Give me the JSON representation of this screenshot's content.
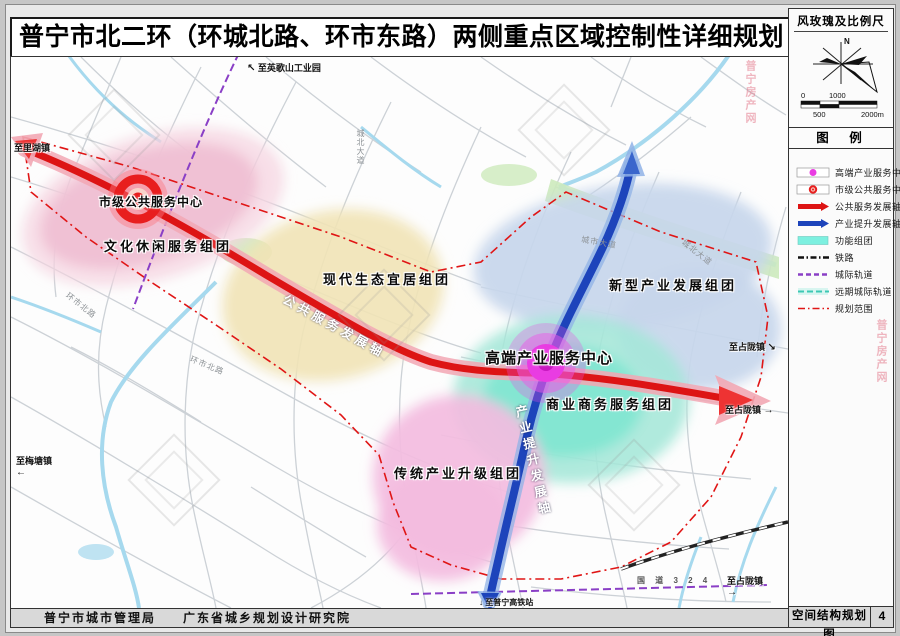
{
  "title": "普宁市北二环（环城北路、环市东路）两侧重点区域控制性详细规划",
  "colors": {
    "axis_red": "#dd1414",
    "axis_red_glow": "#f2a7b4",
    "axis_blue": "#1d44bb",
    "axis_blue_glow": "#8fb2e6",
    "center_magenta": "#e93ce2",
    "center_red": "#e81e1e",
    "cluster_cyan": "#7df0e0",
    "rail_purple": "#8a3fc6",
    "boundary_red": "#e01515"
  },
  "right_panel": {
    "windrose_title": "风玫瑰及比例尺",
    "north": "N",
    "scale": {
      "zero": "0",
      "k1": "1000",
      "k05": "500",
      "k2": "2000m"
    },
    "legend_title": "图　例",
    "legend_items": [
      "高端产业服务中心",
      "市级公共服务中心",
      "公共服务发展轴",
      "产业提升发展轴",
      "功能组团",
      "铁路",
      "城际轨道",
      "远期城际轨道",
      "规划范围"
    ]
  },
  "map": {
    "centers": {
      "city_center": "市级公共服务中心",
      "highend_center": "高端产业服务中心"
    },
    "zones": {
      "culture": "文化休闲服务组团",
      "eco": "现代生态宜居组团",
      "newind": "新型产业发展组团",
      "commerce": "商业商务服务组团",
      "tradind": "传统产业升级组团"
    },
    "axes": {
      "public_axis": "公共服务发展轴",
      "industry_axis": "产业提升发展轴"
    },
    "edges": {
      "yingge": "至英歌山工业园",
      "lihu": "至里湖镇",
      "meitang": "至梅塘镇",
      "zhanlong1": "至占陇镇",
      "zhanlong2": "至占陇镇",
      "zhanlong3": "至占陇镇",
      "gaotie": "至普宁高铁站",
      "guodao": "国 道 3 2 4"
    },
    "roads": {
      "chengbei1": "城北大道",
      "huanshi1": "环市北路",
      "huanshi2": "环市北路",
      "chengshi": "城市大道",
      "chengbei2": "城北大道"
    }
  },
  "icons": {
    "arrow_upleft": "↖",
    "arrow_left": "←",
    "arrow_right": "→",
    "arrow_down": "↓",
    "arrow_se": "↘"
  },
  "footer": {
    "agency": "普宁市城市管理局",
    "designer": "广东省城乡规划设计研究院",
    "sheet_title": "空间结构规划图",
    "sheet_no": "4"
  },
  "watermark_text": "普宁房产网"
}
